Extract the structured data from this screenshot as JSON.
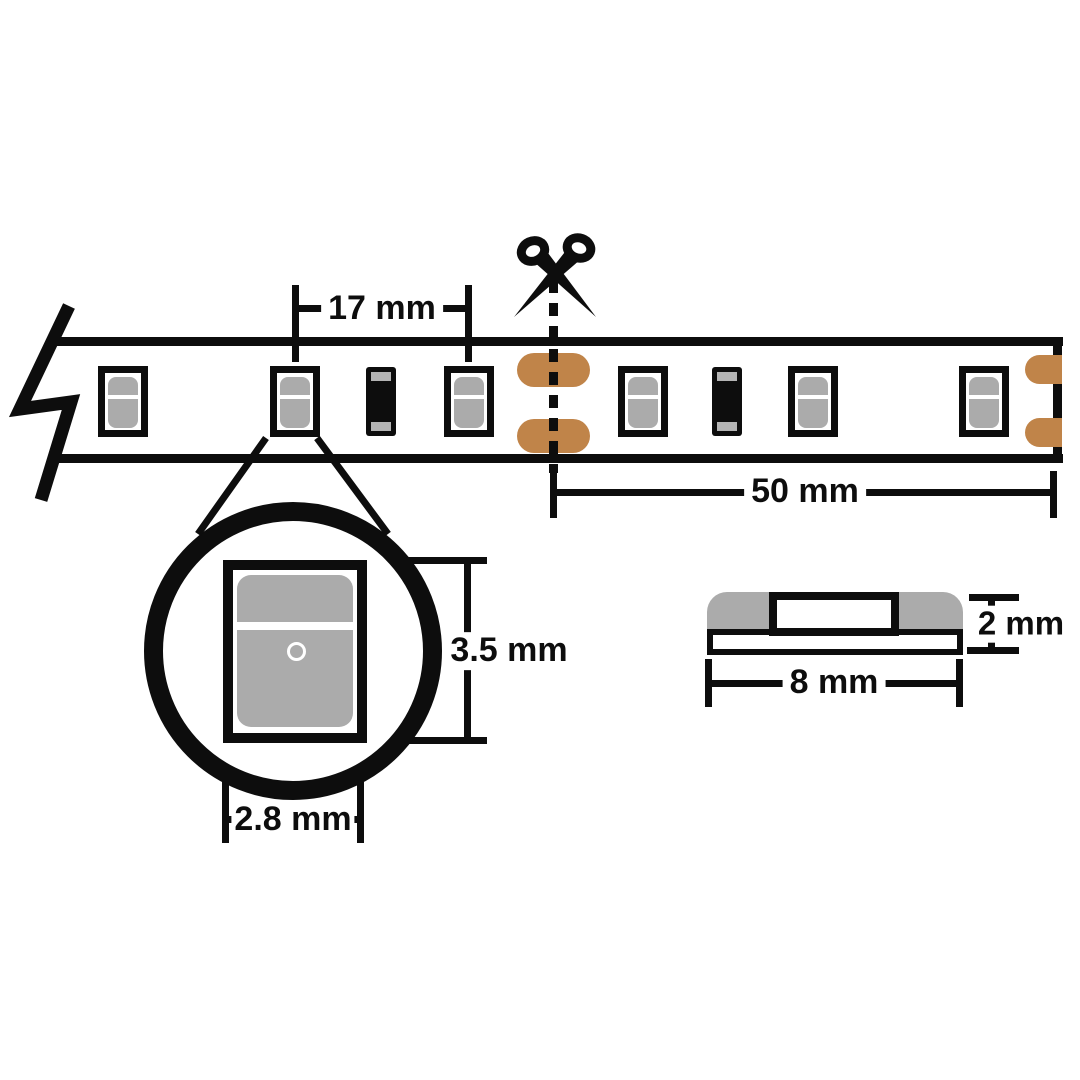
{
  "diagram": {
    "name": "LED strip cutting and dimension diagram",
    "unit": "mm"
  },
  "dimensions": {
    "led_pitch": {
      "label": "17 mm",
      "value": 17
    },
    "cut_segment_length": {
      "label": "50 mm",
      "value": 50
    },
    "led_package_height": {
      "label": "3.5 mm",
      "value": 3.5
    },
    "led_package_width": {
      "label": "2.8 mm",
      "value": 2.8
    },
    "profile_height": {
      "label": "2 mm",
      "value": 2
    },
    "profile_width": {
      "label": "8 mm",
      "value": 8
    }
  },
  "colors": {
    "line": "#0d0d0d",
    "copper": "#c08449",
    "component_gray": "#ababab",
    "resistor_band_gray": "#b4b4b4",
    "background": "#ffffff"
  },
  "icons": {
    "scissors": "scissors-icon",
    "strip_break": "strip-break-icon"
  },
  "strip": {
    "components": [
      {
        "type": "led",
        "x": 98
      },
      {
        "type": "led",
        "x": 270
      },
      {
        "type": "resistor",
        "x": 366
      },
      {
        "type": "led",
        "x": 444
      },
      {
        "type": "solder_pads",
        "x": 517
      },
      {
        "type": "led",
        "x": 618
      },
      {
        "type": "resistor",
        "x": 712
      },
      {
        "type": "led",
        "x": 788
      },
      {
        "type": "led",
        "x": 959
      },
      {
        "type": "edge_pads",
        "x": 1025
      }
    ]
  }
}
